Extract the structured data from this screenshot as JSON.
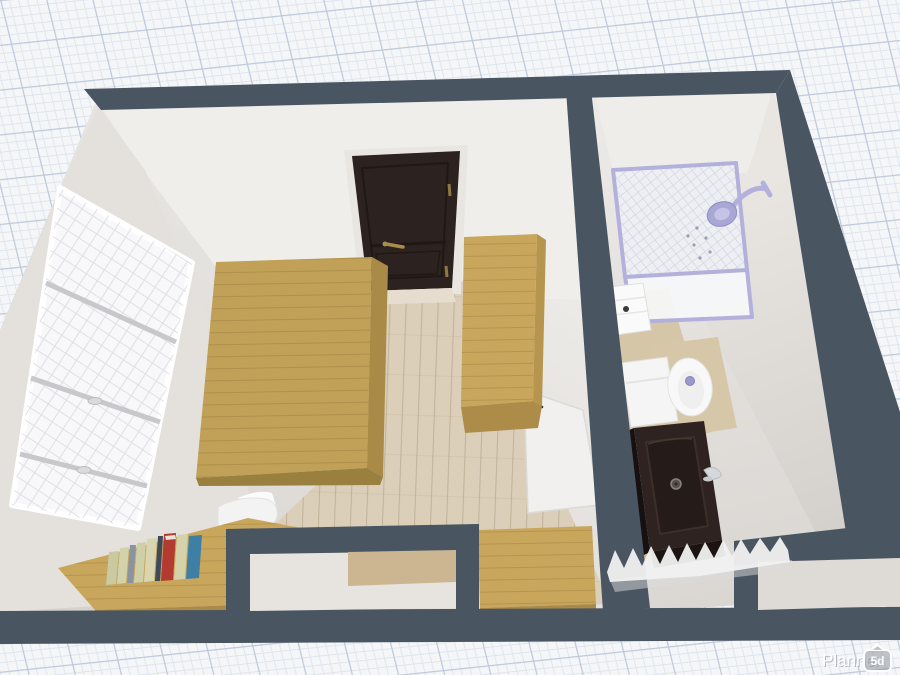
{
  "app": {
    "watermark": {
      "brand": "Planner",
      "badge": "5d"
    }
  },
  "scene": {
    "view": "3d-top-down-floor-plan",
    "rooms": [
      {
        "name": "bedroom",
        "objects": [
          "window",
          "entry-door",
          "bed-platform",
          "wardrobe",
          "desk",
          "books-row",
          "office-chair",
          "dresser",
          "interior-door",
          "bottom-window"
        ]
      },
      {
        "name": "bathroom",
        "objects": [
          "shower-cabin",
          "shower-head",
          "drawer-unit",
          "toilet",
          "vanity-sink",
          "faucet",
          "towel-radiator",
          "bottom-window"
        ]
      }
    ],
    "colors": {
      "canvas": "#f5f6f8",
      "grid_minor": "#dfe5ee",
      "grid_major": "#bdc9da",
      "wall": "#4a5562",
      "interior_light": "#edebe8",
      "interior_shade": "#d6d2ce",
      "floor": "#dbcfba",
      "wood": "#c1a057",
      "wood_light": "#c8a65c",
      "wood_shade": "#a98a46",
      "door_dark": "#2c2220",
      "door_handle": "#a88c4a",
      "glass_frame": "#b3b1db",
      "shower_head": "#a9a7d4",
      "vanity": "#2e2320",
      "toilet": "#f5f5f5"
    },
    "books": [
      {
        "color": "#c9caa2"
      },
      {
        "color": "#d2d3ab"
      },
      {
        "color": "#8b93a0"
      },
      {
        "color": "#cfd0a8"
      },
      {
        "color": "#d8d5b0"
      },
      {
        "color": "#3e4a5a"
      },
      {
        "color": "#b23a31"
      },
      {
        "color": "#d5d1a9"
      },
      {
        "color": "#3f7fa6"
      }
    ]
  }
}
